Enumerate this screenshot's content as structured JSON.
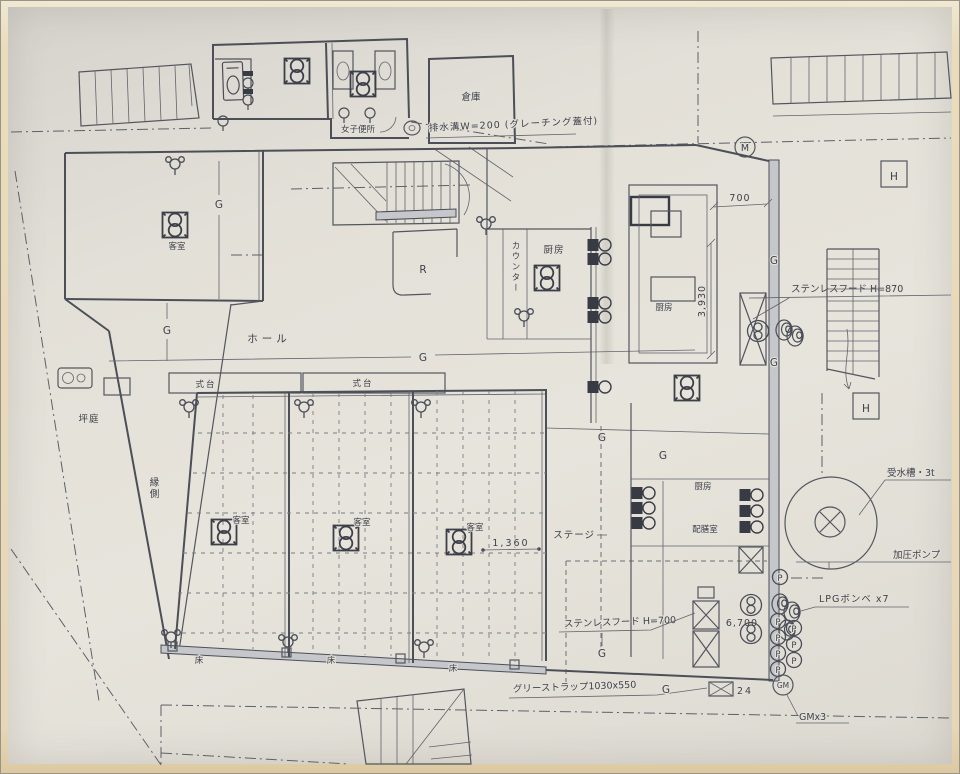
{
  "plan": {
    "rooms": {
      "storage": "倉庫",
      "womens_toilet": "女子便所",
      "hall": "ホール",
      "shikidai": "式台",
      "courtyard": "坪庭",
      "veranda": "縁側",
      "guest_room": "客室",
      "kitchen": "厨房",
      "counter": "カウンター",
      "pantry": "配膳室",
      "stage": "ステージ",
      "floor_label": "床",
      "r_mark": "R"
    },
    "notes": {
      "drain_gutter": "排水溝W=200 (グレーチング蓋付)",
      "hood_870": "ステンレスフード H=870",
      "hood_700": "ステンレスフード H=700",
      "grease_trap": "グリーストラップ1030x550",
      "water_tank": "受水槽・3t",
      "pressure_pump": "加圧ポンプ",
      "lpg_cylinders": "LPGボンベ x7",
      "gm_note": "GMx3"
    },
    "marks": {
      "g": "G",
      "m": "M",
      "h": "H",
      "p": "P",
      "gm": "GM",
      "meter24": "24"
    },
    "dims": {
      "w700": "700",
      "d3930": "3,930",
      "d1360": "1,360",
      "d6700": "6,700"
    },
    "colors": {
      "ink": "#4c4f58",
      "paper": "#e3e0d8",
      "photo_border": "#e9dcbb"
    }
  }
}
